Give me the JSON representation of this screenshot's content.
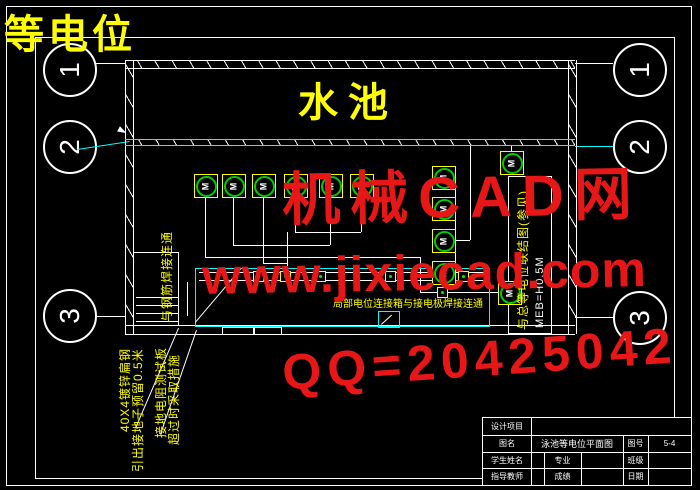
{
  "overlay": {
    "corner_label": "等电位",
    "watermark_line1": "机械CAD网",
    "watermark_line2": "www.jixiecad.com",
    "watermark_line3": "QQ=20425042"
  },
  "grid": {
    "left": [
      "1",
      "2",
      "3"
    ],
    "right": [
      "1",
      "2",
      "3"
    ]
  },
  "plan": {
    "pool_label": "水池",
    "motor_label": "M",
    "notes": {
      "flat_steel": "40X4镀锌扁钢",
      "lead_out": "引出接地子预留0.5米",
      "resistance_test": "接地电阻测试板",
      "resistance_measure": "超过时采取措施",
      "rebar_weld": "与钢筋焊接连通",
      "meb_ref": "与总等电位联结图(参见)",
      "meb_height": "MEB=H0.5M",
      "local_bond": "局部电位连接箱与接电极焊接连通"
    }
  },
  "titleblock": {
    "project_label": "设计项目",
    "name_label": "图名",
    "name_value": "泳池等电位平面图",
    "no_label": "图号",
    "no_value": "5-4",
    "student_label": "学生姓名",
    "major_label": "专业",
    "class_label": "班级",
    "teacher_label": "指导教师",
    "grade_label": "成绩",
    "date_label": "日期"
  },
  "colors": {
    "line_white": "#ffffff",
    "accent_cyan": "#00ffff",
    "annotation_yellow": "#ffff00",
    "symbol_green": "#00cc00",
    "watermark_red": "#e81717"
  }
}
